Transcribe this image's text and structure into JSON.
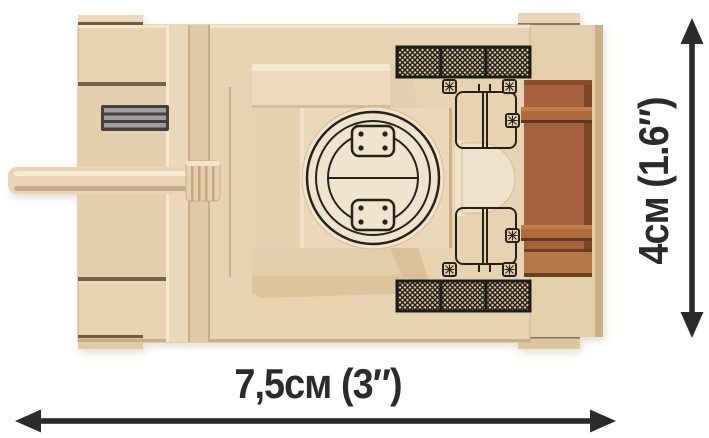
{
  "figure": {
    "kind": "product-dimension-diagram",
    "subject": "brick-built tank model, top view",
    "background": "#ffffff"
  },
  "dimensions": {
    "width_label": "7,5см (3″)",
    "height_label": "4см (1.6″)",
    "arrow_color": "#2b2b2b",
    "label_color": "#2b2b2b"
  },
  "model_colors": {
    "hull_tan": "#e7d3b2",
    "hull_highlight": "#f5e9d1",
    "hull_shadow": "#c8ac84",
    "hatch_cream": "#f0e4cf",
    "print_black": "#262019",
    "grille_dark": "#241f18",
    "crate_brown": "#a3623a",
    "crate_brown_dark": "#7b4425",
    "crate_brown_light": "#b5794a",
    "vent_gray": "#9e9ea2",
    "vent_dark": "#44403b"
  }
}
